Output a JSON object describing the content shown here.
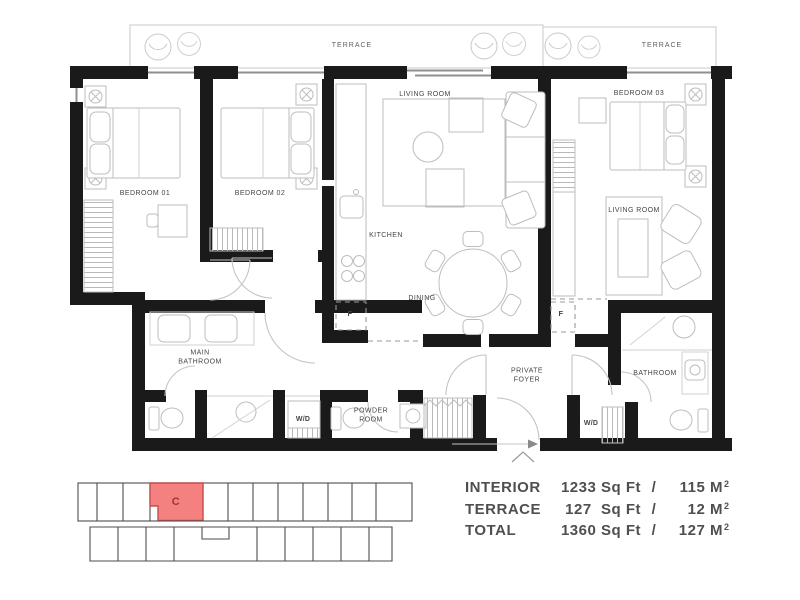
{
  "floor_plan": {
    "terraces": {
      "left_label": "TERRACE",
      "right_label": "TERRACE"
    },
    "rooms": {
      "bedroom_01": "BEDROOM 01",
      "bedroom_02": "BEDROOM 02",
      "bedroom_03": "BEDROOM 03",
      "living_room_main": "LIVING ROOM",
      "living_room_second": "LIVING ROOM",
      "kitchen": "KITCHEN",
      "dining": "DINING",
      "main_bathroom": "MAIN\nBATHROOM",
      "bathroom": "BATHROOM",
      "powder_room": "POWDER\nROOM",
      "private_foyer": "PRIVATE\nFOYER",
      "washer_dryer_left": "W/D",
      "washer_dryer_right": "W/D",
      "fridge_left": "F",
      "fridge_right": "F"
    }
  },
  "key_plan": {
    "unit_label": "C",
    "unit_fill": "#F58080",
    "unit_stroke": "#C2504E",
    "unit_text_color": "#9E3434"
  },
  "area_table": {
    "rows": [
      {
        "label": "INTERIOR",
        "imperial": "1233 Sq Ft",
        "separator": "/",
        "metric": "115 M",
        "metric_sup": "2"
      },
      {
        "label": "TERRACE",
        "imperial": "127  Sq Ft",
        "separator": "/",
        "metric": "12 M",
        "metric_sup": "2"
      },
      {
        "label": "TOTAL",
        "imperial": "1360 Sq Ft",
        "separator": "/",
        "metric": "127 M",
        "metric_sup": "2"
      }
    ]
  }
}
